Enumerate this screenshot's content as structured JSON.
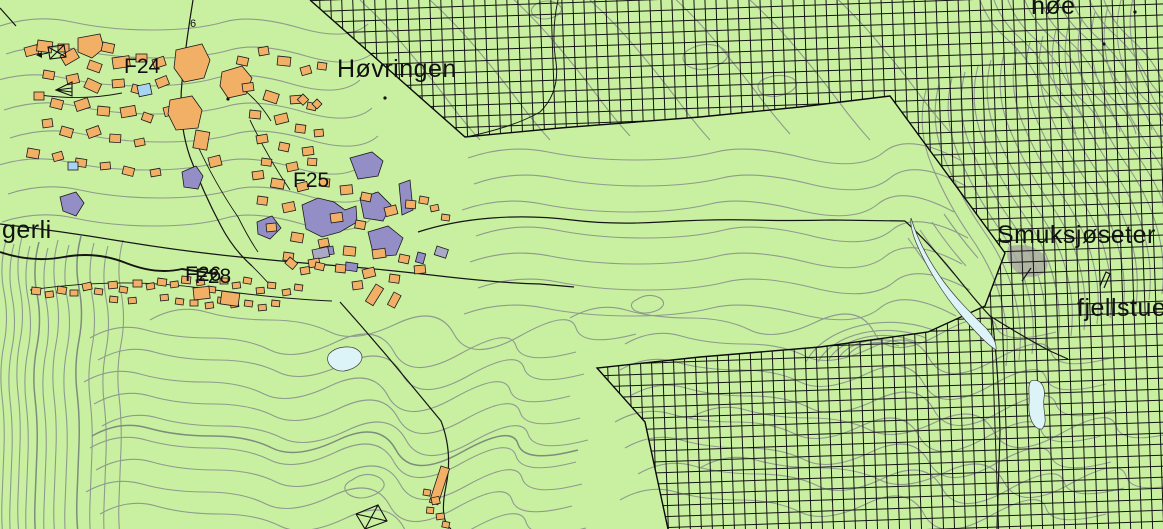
{
  "map": {
    "labels": {
      "hovringen": "Høvringen",
      "hoe_partial": "høe",
      "smuksjoseter": "Smuksjøseter",
      "fjellstue": "fjellstue",
      "gerli_partial": "gerli",
      "f24": "F24",
      "f25": "F25",
      "f26": "F26",
      "f28": "F28",
      "small_mark": "6"
    },
    "colors": {
      "land": "#c9f0a0",
      "contour": "#8e9a8e",
      "contour_index": "#7d8d7d",
      "hatch_line": "#141414",
      "boundary_line": "#0a0a0a",
      "cabin_orange": "#f2b067",
      "zone_purple": "#948ec7",
      "zone_gray": "#abaac6",
      "water_pale": "#dcf4f7",
      "water_blue": "#a9d4f1",
      "road_line": "#151515"
    }
  }
}
